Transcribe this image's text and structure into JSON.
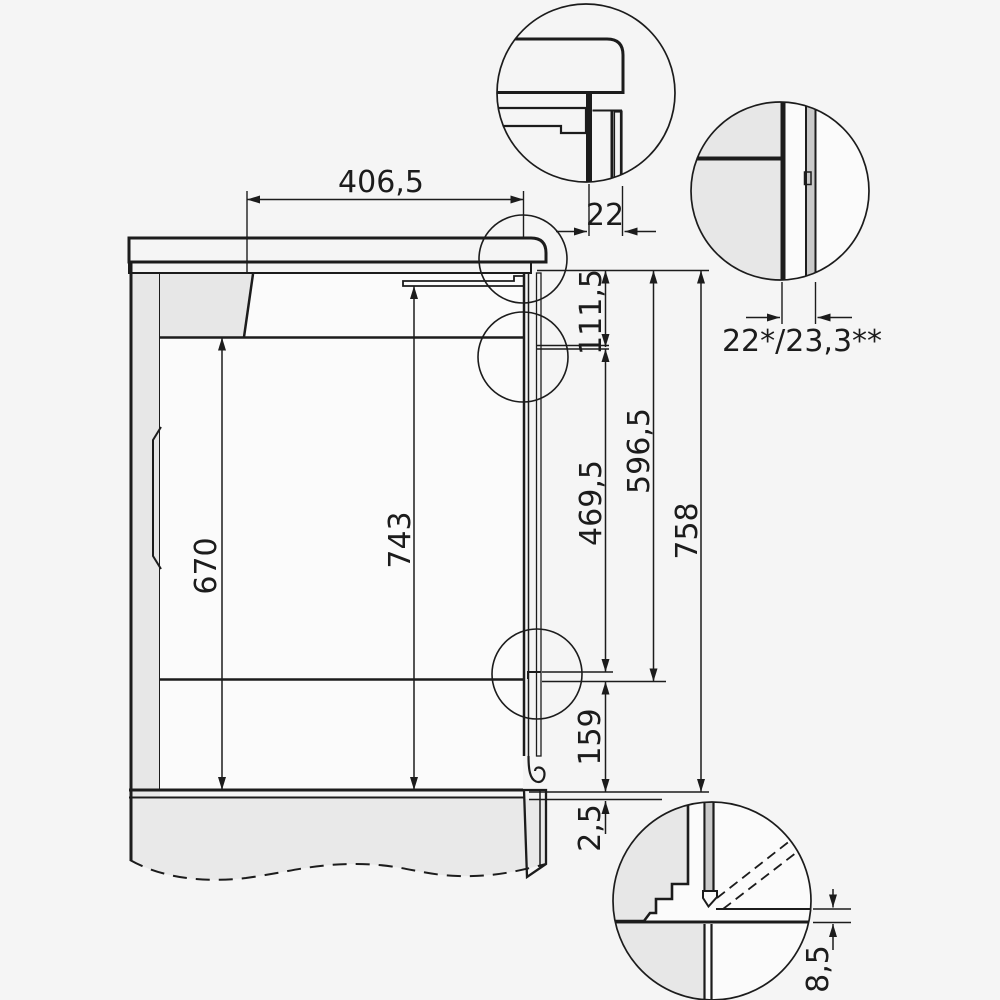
{
  "diagram": {
    "type": "appliance-installation-drawing",
    "dims": {
      "width": "406,5",
      "overhang": "22",
      "panel": "22*/23,3**",
      "h111": "111,5",
      "h469": "469,5",
      "h596": "596,5",
      "h758": "758",
      "h670": "670",
      "h743": "743",
      "h159": "159",
      "h2_5": "2,5",
      "h8_5": "8,5"
    },
    "colors": {
      "background": "#f5f5f5",
      "panel_grey": "#e7e7e7",
      "light_fill": "#fbfbfb",
      "glass_grey": "#c9c9c9",
      "line": "#1c1c1c"
    }
  }
}
